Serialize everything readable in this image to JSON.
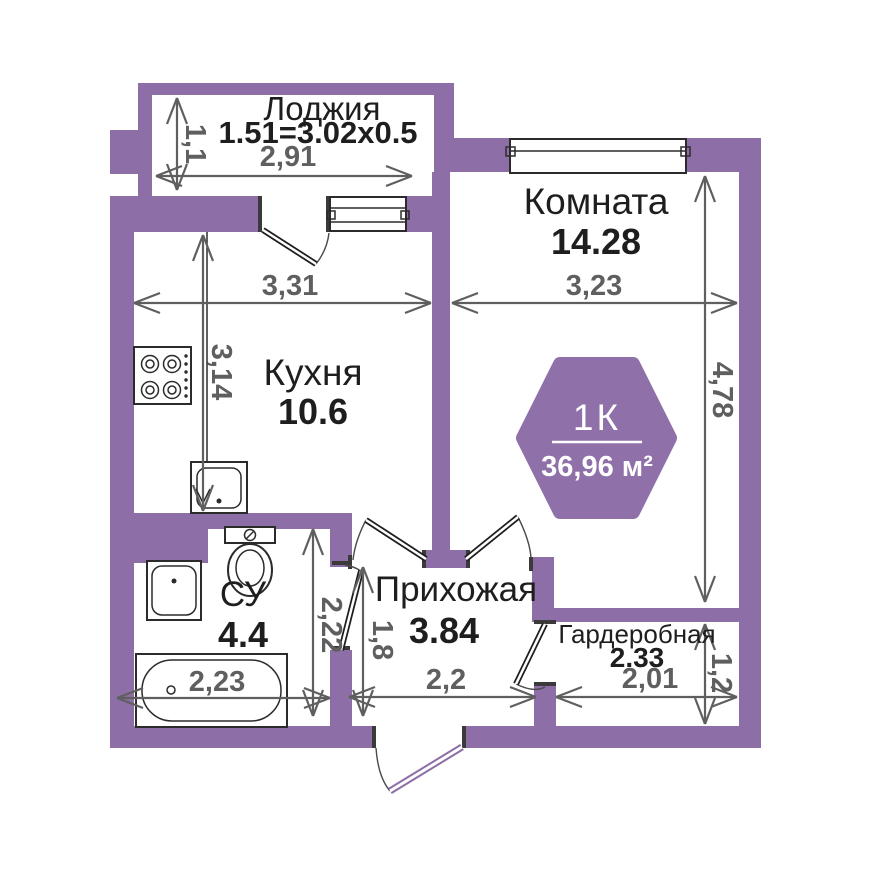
{
  "colors": {
    "wall": "#8D6EA6",
    "badge": "#9070A8",
    "label": "#1E1E1E",
    "dimension": "#5F5F5F",
    "background": "#FFFFFF"
  },
  "badge": {
    "type_label": "1К",
    "area_label": "36,96 м²"
  },
  "rooms": {
    "loggia": {
      "name": "Лоджия",
      "formula": "1.51=3.02x0.5",
      "width": "2,91",
      "depth": "1,1"
    },
    "living_room": {
      "name": "Комната",
      "area": "14.28",
      "width": "3,23",
      "depth": "4,78"
    },
    "kitchen": {
      "name": "Кухня",
      "area": "10.6",
      "width": "3,31",
      "depth": "3,14"
    },
    "bathroom": {
      "name": "СУ",
      "area": "4.4",
      "bath_width": "2,23",
      "depth": "2,22"
    },
    "hallway": {
      "name": "Прихожая",
      "area": "3.84",
      "width": "2,2",
      "door_wall": "1,8"
    },
    "wardrobe": {
      "name": "Гардеробная",
      "area": "2.33",
      "width": "2,01",
      "depth": "1,2"
    }
  }
}
